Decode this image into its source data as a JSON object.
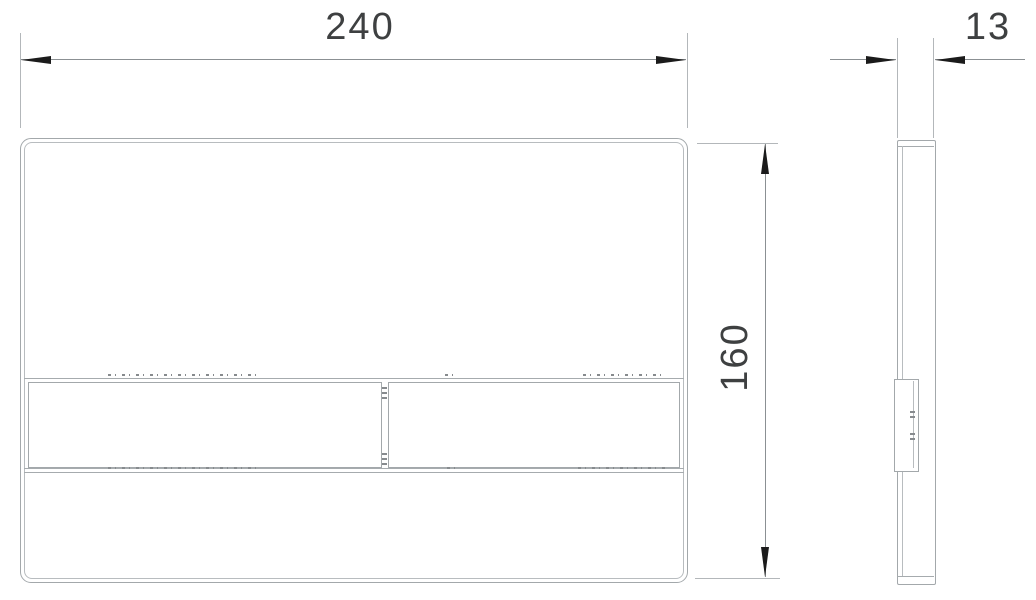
{
  "drawing": {
    "type": "technical-drawing",
    "views": {
      "front": "flush-plate front view with two buttons",
      "side": "flush-plate side profile"
    },
    "dimensions": {
      "width": "240",
      "height": "160",
      "depth": "13"
    },
    "colors": {
      "background": "#ffffff",
      "outline": "#a3a8ab",
      "dimension_line": "#8b9093",
      "arrow": "#1b1b1b",
      "text": "#3e4041"
    }
  }
}
